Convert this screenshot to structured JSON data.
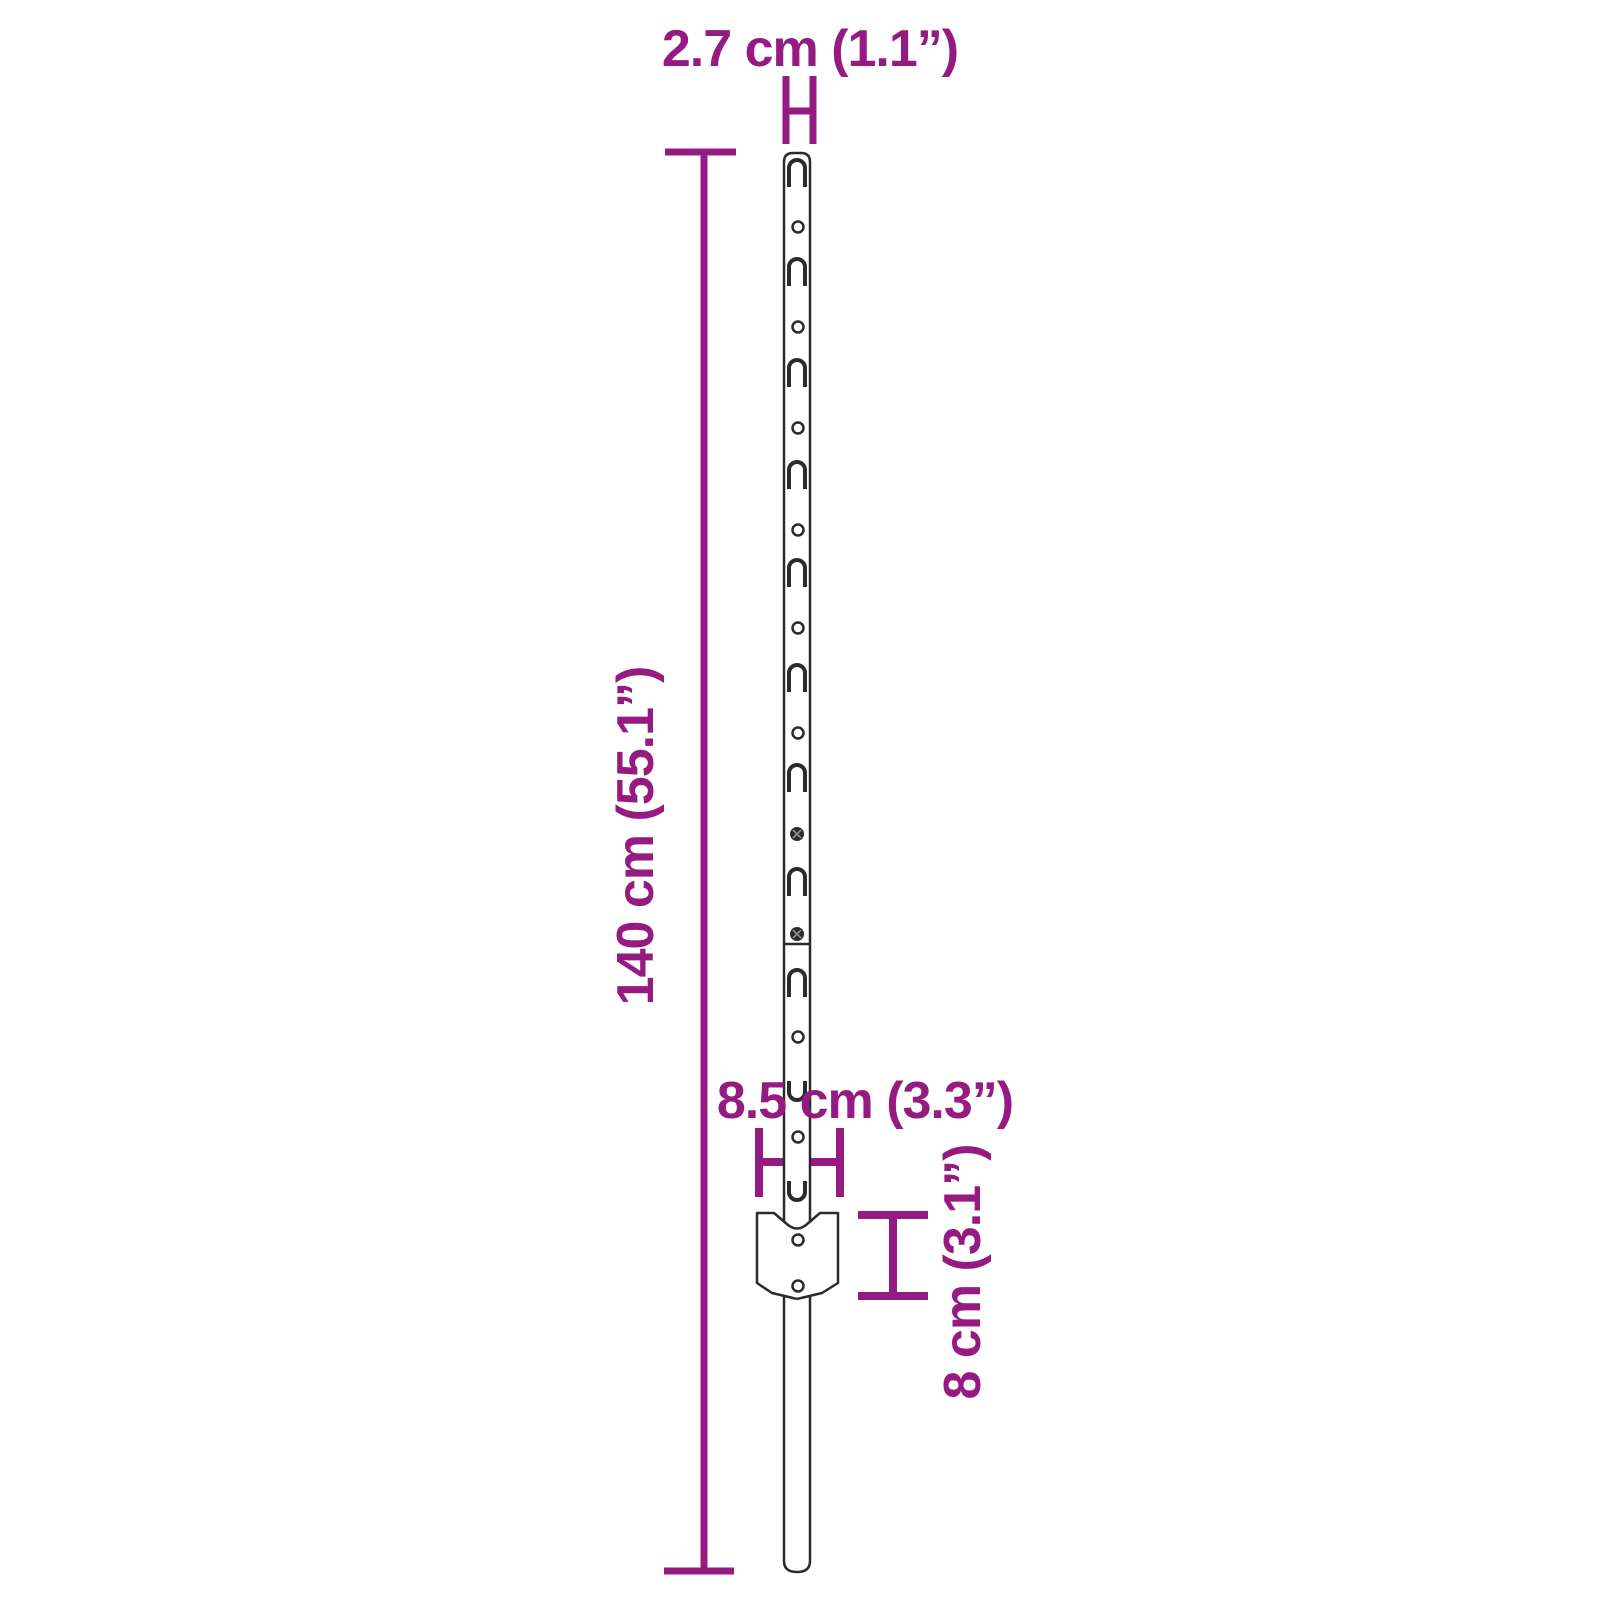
{
  "diagram": {
    "subject": "metal-u-fence-post-with-anchor-plate",
    "labels": {
      "post_width": "2.7 cm (1.1”)",
      "post_height": "140 cm (55.1”)",
      "plate_width": "8.5 cm (3.3”)",
      "plate_height": "8 cm (3.1”)"
    },
    "colors": {
      "dimension": "#951B81",
      "outline": "#2B2B2B",
      "background": "#FFFFFF"
    }
  }
}
